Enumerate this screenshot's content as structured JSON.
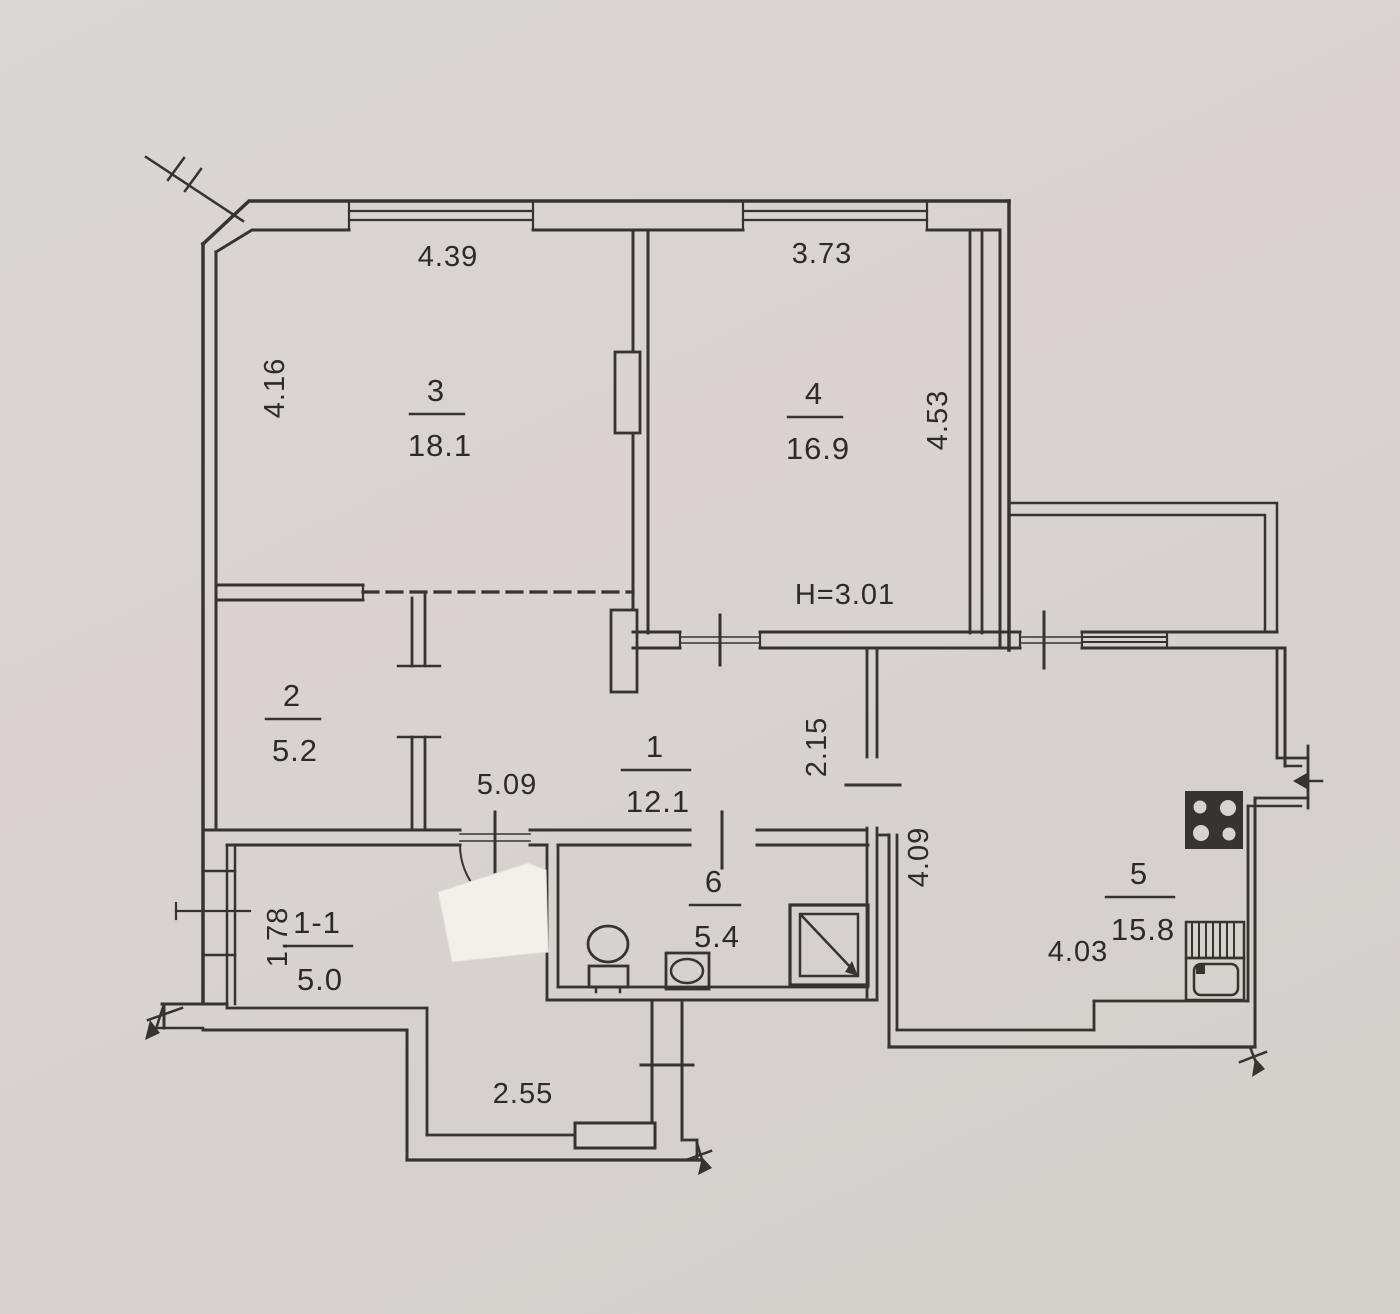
{
  "plan_labels": {
    "ceiling_height": "H=3.01"
  },
  "rooms": [
    {
      "number": "1",
      "area": "12.1"
    },
    {
      "number": "1-1",
      "area": "5.0"
    },
    {
      "number": "2",
      "area": "5.2"
    },
    {
      "number": "3",
      "area": "18.1"
    },
    {
      "number": "4",
      "area": "16.9"
    },
    {
      "number": "5",
      "area": "15.8"
    },
    {
      "number": "6",
      "area": "5.4"
    }
  ],
  "dimensions": {
    "room3_top": "4.39",
    "room3_left": "4.16",
    "room4_top": "3.73",
    "room4_right": "4.53",
    "hallway_length": "5.09",
    "corridor_height": "2.15",
    "kitchen_left": "4.09",
    "kitchen_bottom": "4.03",
    "hall_1_1_left": "1.78",
    "vestibule_bottom": "2.55"
  },
  "fixtures": [
    "toilet",
    "washbasin",
    "shower-tray",
    "stove",
    "kitchen-sink"
  ],
  "features": [
    "balcony",
    "windows",
    "entrance-door",
    "correction-patch"
  ],
  "colors": {
    "paper": "#d7d3cf",
    "ink": "#37342f",
    "patch": "#f3f0e9"
  }
}
